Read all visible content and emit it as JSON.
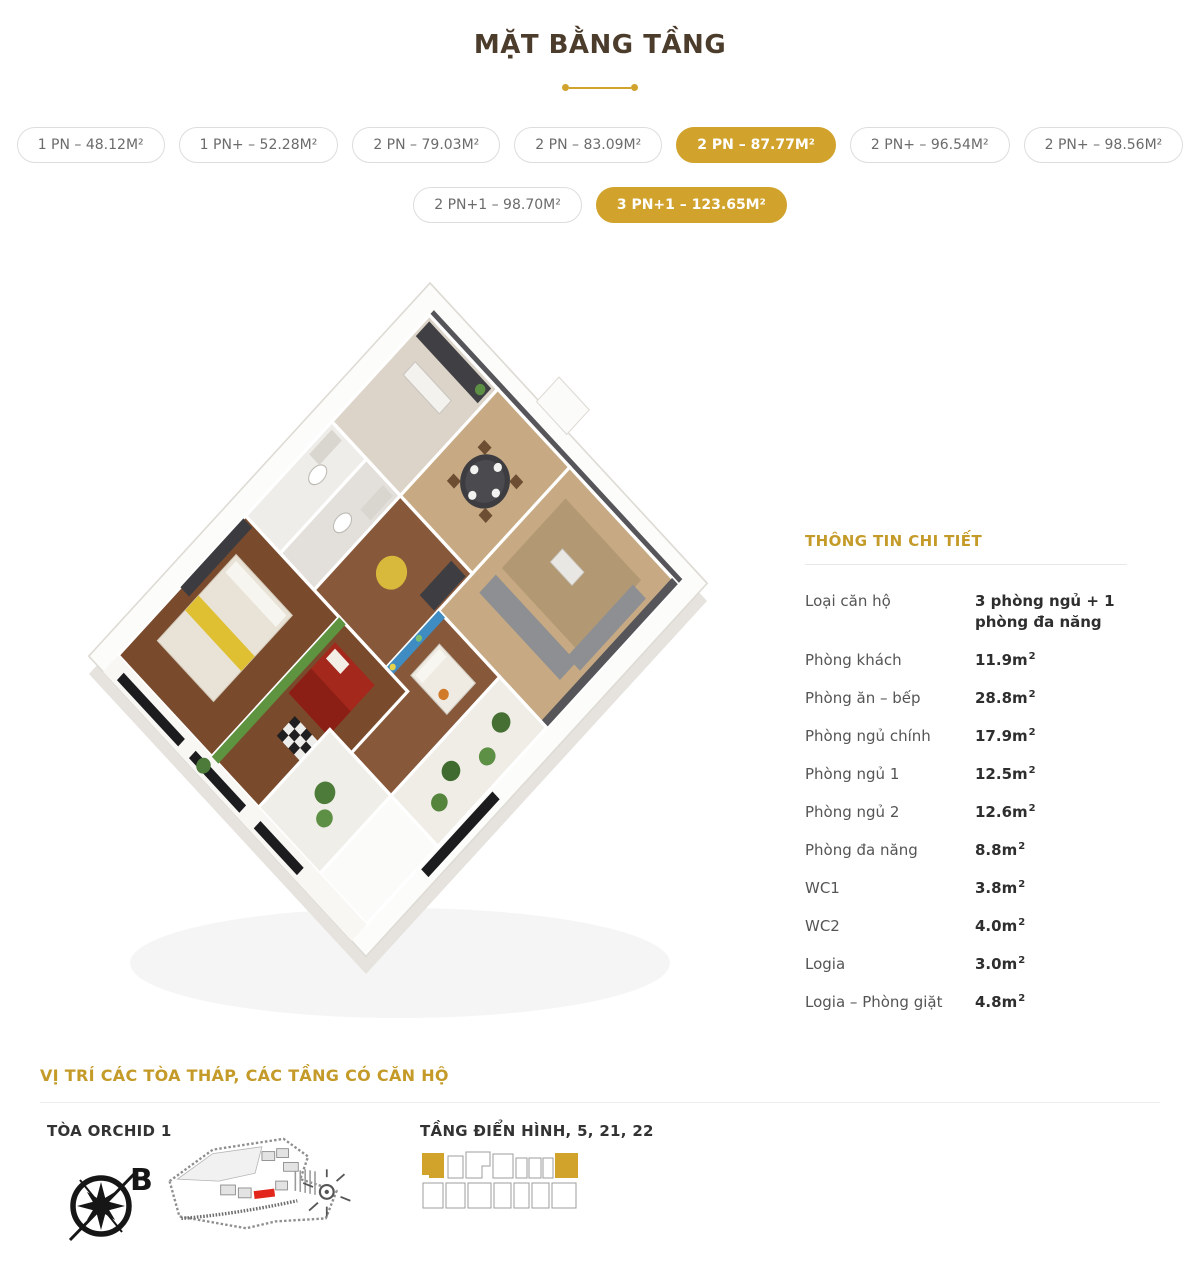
{
  "page": {
    "title": "MẶT BẰNG TẦNG"
  },
  "tabs": {
    "row1": [
      {
        "label": "1 PN – 48.12M²",
        "active": false
      },
      {
        "label": "1 PN+ – 52.28M²",
        "active": false
      },
      {
        "label": "2 PN – 79.03M²",
        "active": false
      },
      {
        "label": "2 PN – 83.09M²",
        "active": false
      },
      {
        "label": "2 PN – 87.77M²",
        "active": true
      },
      {
        "label": "2 PN+ – 96.54M²",
        "active": false
      },
      {
        "label": "2 PN+ – 98.56M²",
        "active": false
      }
    ],
    "row2": [
      {
        "label": "2 PN+1 – 98.70M²",
        "active": false
      },
      {
        "label": "3 PN+1 – 123.65M²",
        "active": true
      }
    ]
  },
  "details": {
    "heading": "THÔNG TIN CHI TIẾT",
    "type_row": {
      "label": "Loại căn hộ",
      "value": "3 phòng ngủ + 1 phòng đa năng"
    },
    "rows": [
      {
        "label": "Phòng khách",
        "value": "11.9m",
        "sup": "2"
      },
      {
        "label": "Phòng ăn – bếp",
        "value": "28.8m",
        "sup": "2"
      },
      {
        "label": "Phòng ngủ chính",
        "value": "17.9m",
        "sup": "2"
      },
      {
        "label": "Phòng ngủ 1",
        "value": "12.5m",
        "sup": "2"
      },
      {
        "label": "Phòng ngủ 2",
        "value": "12.6m",
        "sup": "2"
      },
      {
        "label": "Phòng đa năng",
        "value": "8.8m",
        "sup": "2"
      },
      {
        "label": "WC1",
        "value": "3.8m",
        "sup": "2"
      },
      {
        "label": "WC2",
        "value": "4.0m",
        "sup": "2"
      },
      {
        "label": "Logia",
        "value": "3.0m",
        "sup": "2"
      },
      {
        "label": "Logia – Phòng giặt",
        "value": "4.8m",
        "sup": "2"
      }
    ]
  },
  "location": {
    "heading": "VỊ TRÍ CÁC TÒA THÁP, CÁC TẦNG CÓ CĂN HỘ",
    "tower": {
      "title": "TÒA ORCHID 1",
      "compass_label": "B"
    },
    "floors": {
      "title": "TẦNG ĐIỂN HÌNH, 5, 21, 22"
    }
  },
  "icons": {
    "compass": "compass-rose-icon",
    "site_map": "masterplan-map",
    "floor_diagram": "floor-plate-diagram",
    "floorplan_render": "3d-apartment-floorplan"
  },
  "colors": {
    "accent_gold": "#D1A32C",
    "heading_gold": "#C49A28",
    "title_brown": "#4B3C2C",
    "tab_text_gray": "#6B6B6B",
    "map_highlight_red": "#E2261B"
  }
}
